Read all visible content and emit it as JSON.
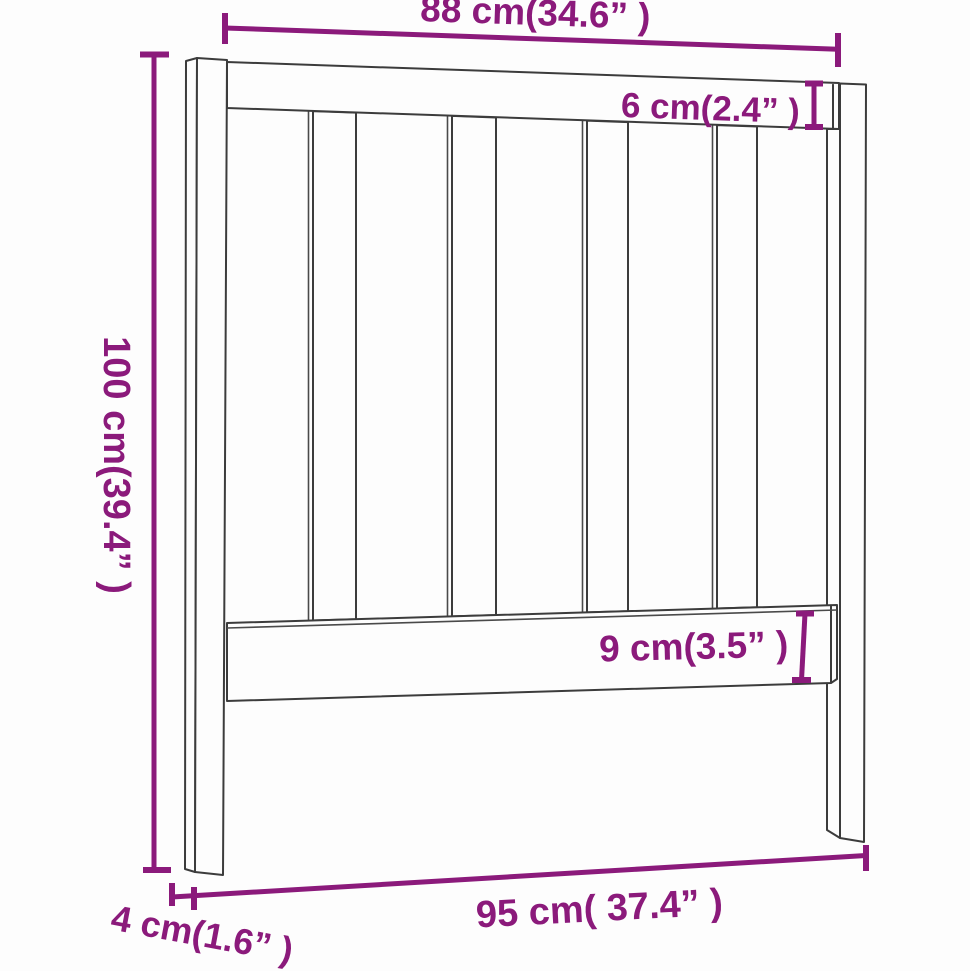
{
  "diagram": {
    "kind": "furniture-dimension-line-drawing",
    "colors": {
      "accent": "#8B1A7B",
      "line": "#3C3C3C",
      "background": "#FDFDFD"
    },
    "dimensions": {
      "inner_width": {
        "label": "88 cm(34.6” )",
        "cm": 88,
        "inches": 34.6
      },
      "top_rail_thickness": {
        "label": "6 cm(2.4” )",
        "cm": 6,
        "inches": 2.4
      },
      "height": {
        "label": "100 cm(39.4” )",
        "cm": 100,
        "inches": 39.4
      },
      "lower_rail_thickness": {
        "label": "9 cm(3.5” )",
        "cm": 9,
        "inches": 3.5
      },
      "overall_width": {
        "label": "95 cm( 37.4” )",
        "cm": 95,
        "inches": 37.4
      },
      "post_depth": {
        "label": "4 cm(1.6” )",
        "cm": 4,
        "inches": 1.6
      }
    }
  }
}
